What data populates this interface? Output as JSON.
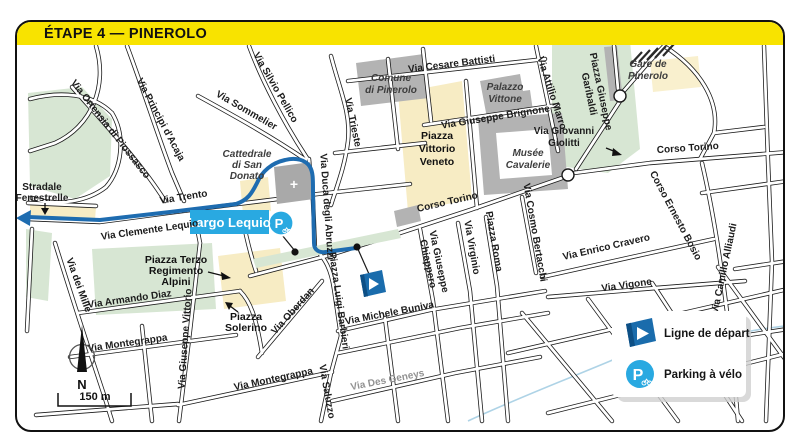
{
  "header": {
    "title": "ÉTAPE 4 — PINEROLO"
  },
  "map": {
    "highlight_label": "Largo Lequio",
    "parking_letter": "P",
    "cathedral_cross": "+",
    "streets": {
      "ortensia": "Via Ortensia di Piossasco",
      "principi": "Via Principi d'Acaja",
      "sommelier": "Via Sommelier",
      "silvio_pellico": "Via Silvio Pellico",
      "trieste": "Via Trieste",
      "cesare_battisti": "Via Cesare Battisti",
      "brignone": "Via Giuseppe Brignone",
      "attilio_marro": "Via Attilio Marro",
      "corso_torino": "Corso Torino",
      "ernesto_bosio": "Corso Ernesto Bosio",
      "camillo_alliaudi": "Via Camillo Alliaudi",
      "enrico_cravero": "Via Enrico Cravero",
      "vigone": "Via Vigone",
      "cosmo_bertacchi": "Via Cosmo Bertacchi",
      "chiappero": [
        "Via Giuseppe",
        "Chiappero"
      ],
      "virginio": "Via Virginio",
      "piazza_roma": "Piazza Roma",
      "duca_abruzzi": "Via Duca degli Abruzzi",
      "trento": "Via Trento",
      "clemente_lequio": "Via Clemente Lequio",
      "fenestrelle": [
        "Stradale",
        "Fenestrelle"
      ],
      "dei_mille": "Via dei Mille",
      "armando_diaz": "Via Armando Diaz",
      "montegrappa": "Via Montegrappa",
      "giuseppe_vittorio": "Via Giuseppe Vittorio",
      "oberdan": "Via Oberdan",
      "luigi_barbieri": "Piazza Luigi Barbieri",
      "michele_buniva": "Via Michele Buniva",
      "des_geneys": "Via Des Geneys",
      "saluzzo": "Via Saluzzo",
      "giolitti": [
        "Via Giovanni",
        "Giolitti"
      ]
    },
    "landmarks": {
      "comune": [
        "Comune",
        "di Pinerolo"
      ],
      "palazzo_vittone": [
        "Palazzo",
        "Vittone"
      ],
      "cattedrale": [
        "Cattedrale",
        "di San",
        "Donato"
      ],
      "vittorio_veneto": [
        "Piazza",
        "Vittorio",
        "Veneto"
      ],
      "musee": [
        "Musée",
        "Cavalerie"
      ],
      "gare": [
        "Gare de",
        "Pinerolo"
      ],
      "garibaldi": [
        "Piazza Giuseppe",
        "Garibaldi"
      ],
      "terzo": [
        "Piazza Terzo",
        "Regimento",
        "Alpini"
      ],
      "solerino": [
        "Piazza",
        "Solerino"
      ]
    }
  },
  "legend": {
    "items": [
      {
        "icon": "start-flag-icon",
        "label": "Ligne de départ"
      },
      {
        "icon": "bike-parking-icon",
        "label": "Parking à vélo"
      }
    ]
  },
  "scale": {
    "label": "150 m"
  },
  "compass": {
    "north": "N"
  },
  "colors": {
    "header_bg": "#F8E300",
    "route_blue": "#1E6CB0",
    "highlight_blue": "#29A9E1",
    "park_green": "#D7E6D3",
    "piazza_yellow": "#F7ECC4",
    "building_grey": "#B3B3B3"
  }
}
